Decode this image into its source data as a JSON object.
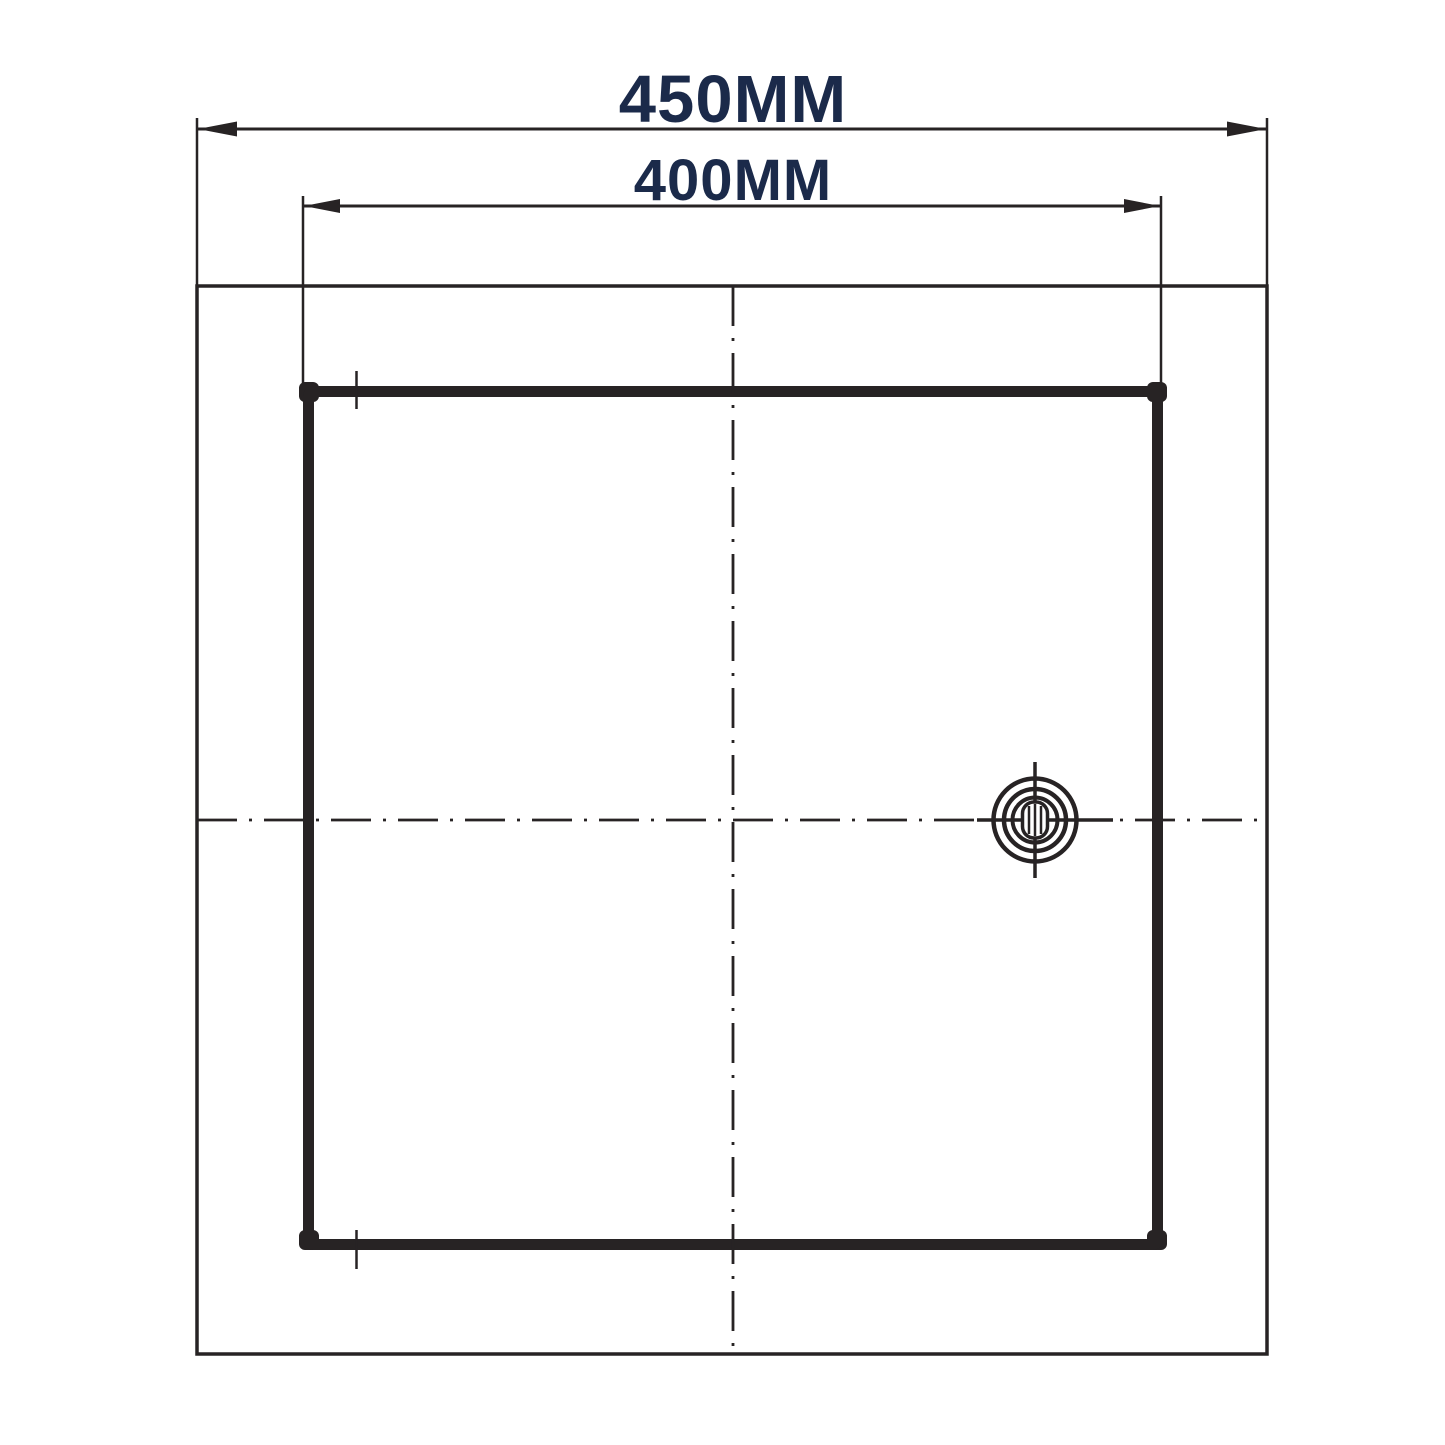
{
  "drawing": {
    "labels": {
      "outer_width": "450MM",
      "inner_width": "400MM"
    },
    "values_mm": {
      "outer_width": 450,
      "inner_width": 400
    },
    "colors": {
      "label_text": "#1b2a4a",
      "line_work": "#272324",
      "background": "#ffffff"
    },
    "icons": {
      "lock_icon": "concentric-circle-cam-lock-keyhole"
    }
  }
}
